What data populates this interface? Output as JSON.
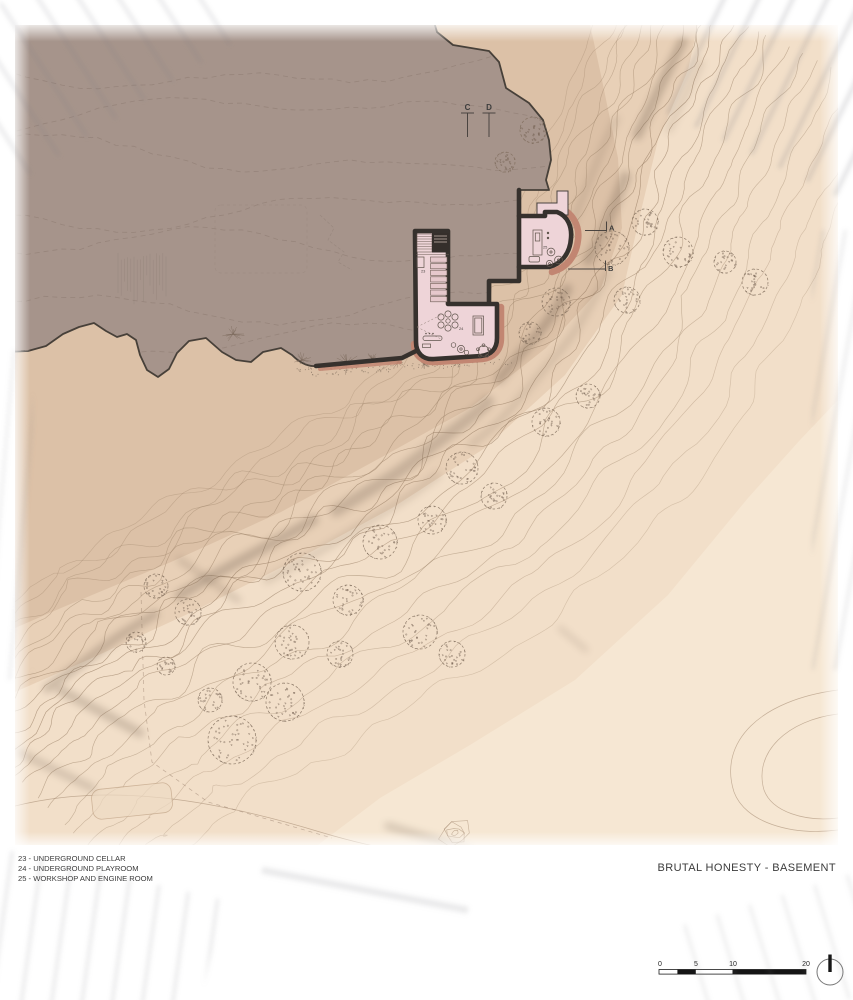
{
  "palette": {
    "paper": "#ffffff",
    "terrain_base": "#f2dfc9",
    "terrain_mid": "#e8d0b7",
    "terrain_band": "#dcc1a7",
    "terrain_light": "#f6e7d3",
    "excavation_mass": "#a6948b",
    "mass_edge": "#474039",
    "contour_line": "#9c8268",
    "hillshade": "#5c4b3e",
    "wall": "#36312d",
    "room_fill": "#eed4d8",
    "room_accent": "#c28672",
    "vegetation": "#6f5d4e",
    "ink": "#3c3c3c"
  },
  "title_block": {
    "project_title": "BRUTAL HONESTY - BASEMENT"
  },
  "legend": {
    "entries": [
      "23 - UNDERGROUND CELLAR",
      "24 - UNDERGROUND PLAYROOM",
      "25 - WORKSHOP AND ENGINE ROOM"
    ]
  },
  "rooms": [
    {
      "number": "23",
      "name": "UNDERGROUND CELLAR"
    },
    {
      "number": "24",
      "name": "UNDERGROUND PLAYROOM"
    },
    {
      "number": "25",
      "name": "WORKSHOP AND ENGINE ROOM"
    }
  ],
  "section_markers": {
    "top": [
      "C",
      "D"
    ],
    "side": [
      "A",
      "B"
    ]
  },
  "scale_bar": {
    "labels": [
      "0",
      "5",
      "10",
      "20"
    ]
  }
}
